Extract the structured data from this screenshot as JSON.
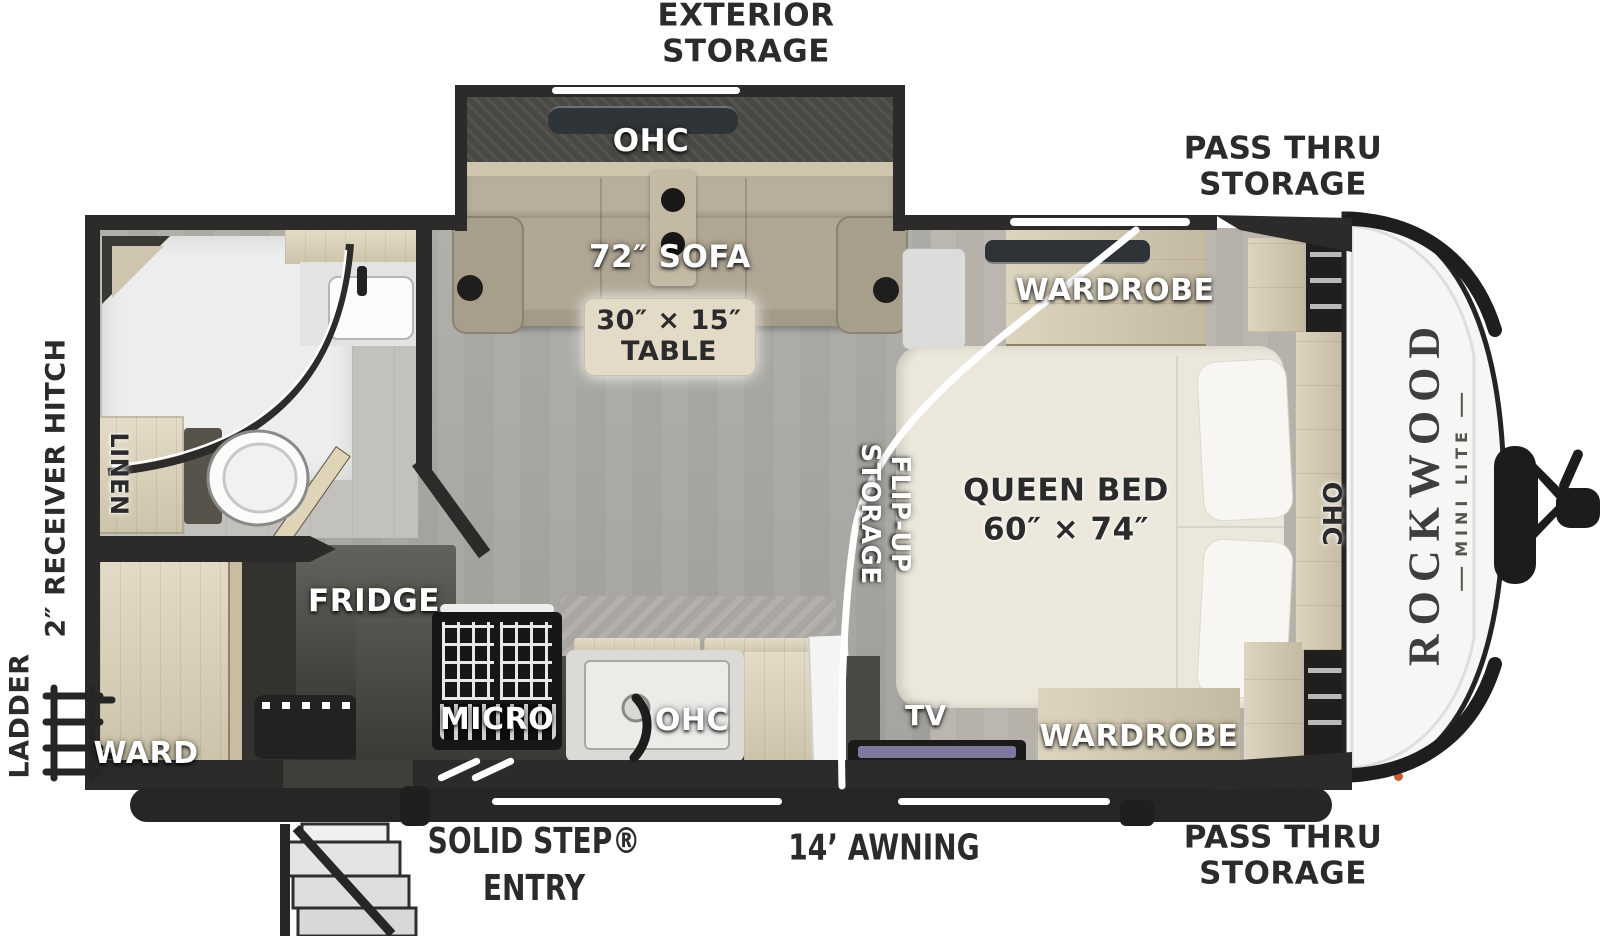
{
  "floorplan": {
    "brand": {
      "name": "ROCKWOOD",
      "series": "MINI LITE"
    },
    "exterior_labels": {
      "exterior_storage": [
        "EXTERIOR",
        "STORAGE"
      ],
      "pass_thru_top": [
        "PASS THRU",
        "STORAGE"
      ],
      "pass_thru_bottom": [
        "PASS THRU",
        "STORAGE"
      ],
      "ladder": "LADDER",
      "receiver_hitch": "2″ RECEIVER HITCH",
      "solid_step": [
        "SOLID STEP®",
        "ENTRY"
      ],
      "awning": "14’ AWNING"
    },
    "interior_labels": {
      "ohc_slide": "OHC",
      "sofa": "72″ SOFA",
      "table": [
        "30″ × 15″",
        "TABLE"
      ],
      "wardrobe_top": "WARDROBE",
      "wardrobe_bottom": "WARDROBE",
      "queen_bed": [
        "QUEEN BED",
        "60″ × 74″"
      ],
      "ohc_bed": "OHC",
      "flip_up_storage": [
        "FLIP-UP",
        "STORAGE"
      ],
      "linen": "LINEN",
      "fridge": "FRIDGE",
      "ward": "WARD",
      "micro": "MICRO",
      "ohc_kitchen": "OHC",
      "tv": "TV"
    },
    "colors": {
      "wall": "#2c2b29",
      "floor": "#a8a5a0",
      "wood": "#dcd2b8",
      "bed": "#ebe7db",
      "front_cap": "#f6f6f5",
      "label_dark": "#2b2b2b",
      "marker_light": "#c4602f",
      "tv_screen": "#8f87b6"
    }
  }
}
